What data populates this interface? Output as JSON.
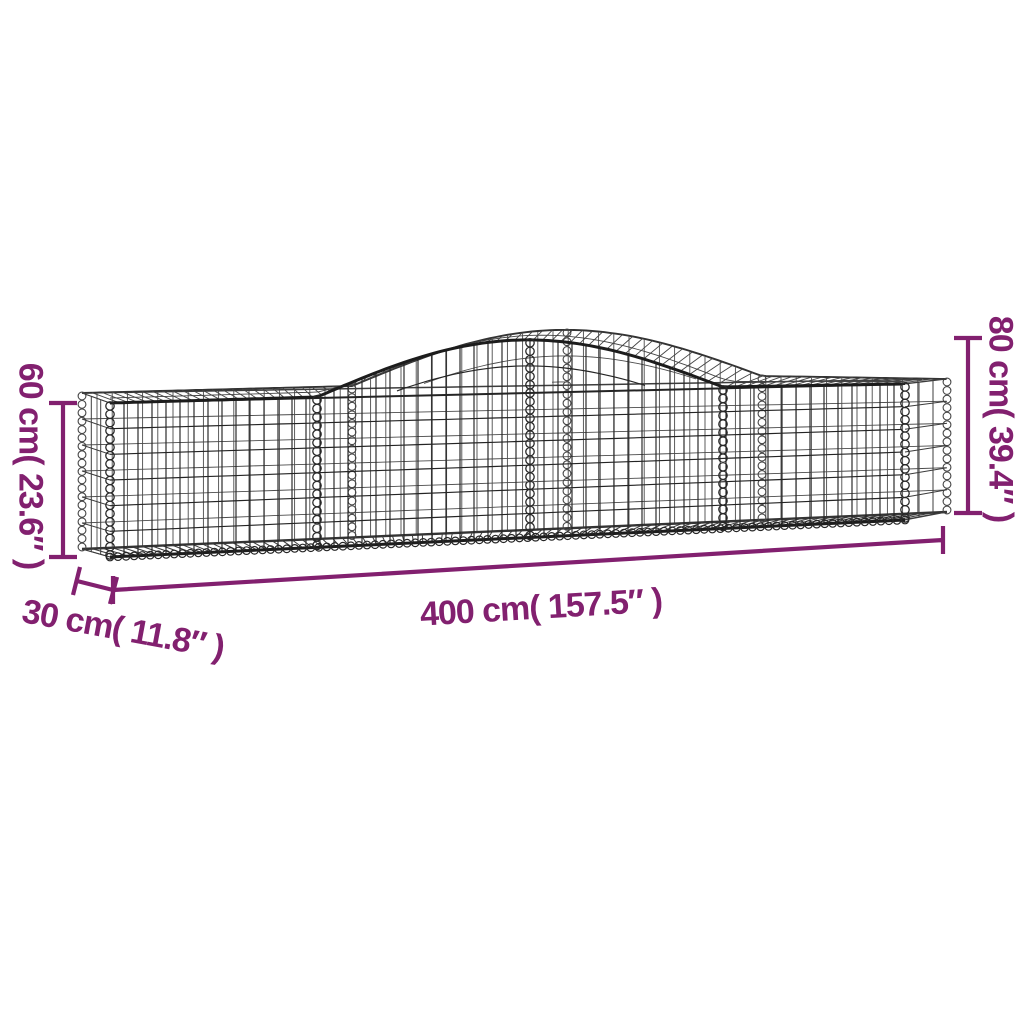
{
  "diagram": {
    "subject": "arched gabion wire-mesh basket with dimension annotations",
    "background_color": "#ffffff",
    "accent_color": "#82206F",
    "wire_color": "#2b2b2b",
    "labels": {
      "height_left": "60 cm( 23.6″ )",
      "height_right": "80 cm( 39.4″ )",
      "length": "400 cm( 157.5″ )",
      "depth": "30 cm( 11.8″ )"
    },
    "values": {
      "height_left_cm": 60,
      "height_left_in": 23.6,
      "height_right_cm": 80,
      "height_right_in": 39.4,
      "length_cm": 400,
      "length_in": 157.5,
      "depth_cm": 30,
      "depth_in": 11.8
    }
  }
}
